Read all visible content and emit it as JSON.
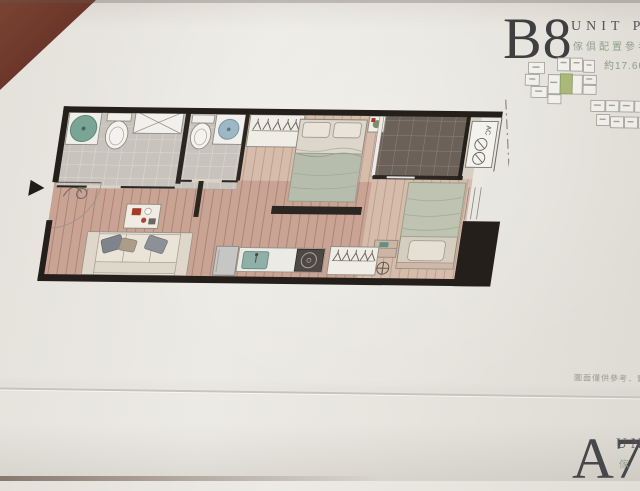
{
  "b8_section": {
    "title": "B8",
    "subtitle": "UNIT PLAN",
    "subtitle_cn": "傢俱配置參考圖",
    "area_label": "約17.60"
  },
  "a7_section": {
    "title": "A7",
    "subtitle": "UN",
    "subtitle_cn": "傢"
  },
  "footnote": "圖面僅供參考．實際",
  "floor_plan": {
    "ac_label": "AC"
  },
  "key_plan": {
    "highlighted_unit": "B8"
  },
  "colors": {
    "paper": "#e7e5de",
    "table_wood": "#6a3529",
    "wall": "#241f1b",
    "floor_wood": "#c9a394",
    "balcony_tile": "#6b6159",
    "highlight_green": "#aab879",
    "title_text": "#3f3e41",
    "cn_text": "#92a08c"
  }
}
